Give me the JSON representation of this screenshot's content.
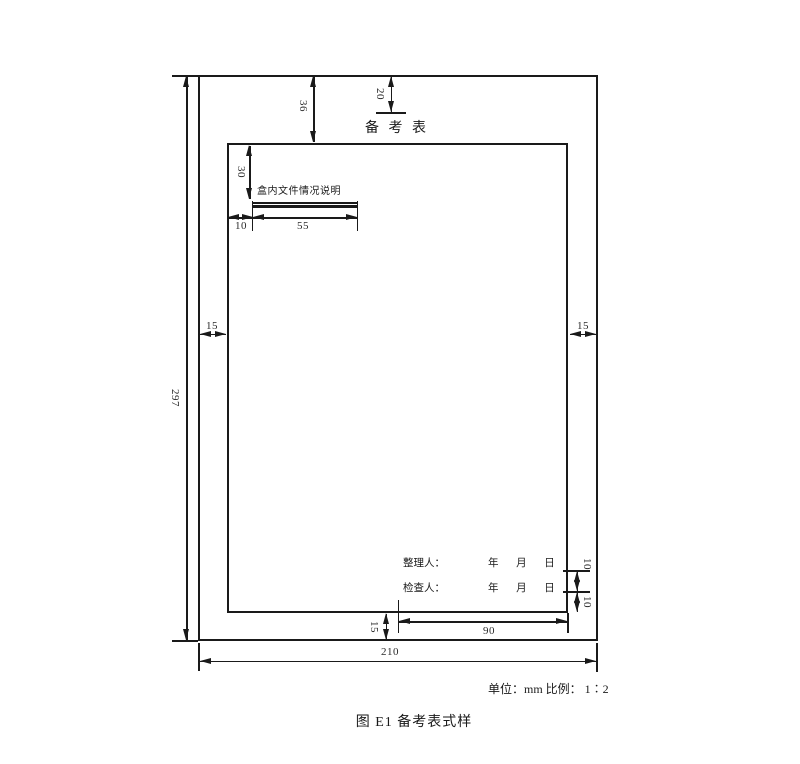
{
  "figure": {
    "title": "备 考 表",
    "caption": "图 E1 备考表式样",
    "units_scale": "单位：mm 比例： 1∶2"
  },
  "form": {
    "note": "盒内文件情况说明",
    "organizer": "整理人：",
    "checker": "检查人：",
    "date": "年 月 日"
  },
  "dims": {
    "page_height": "297",
    "page_width": "210",
    "margin_left": "15",
    "margin_right": "15",
    "title_offset": "20",
    "header": "36",
    "note_offset": "30",
    "note_indent": "10",
    "note_line": "55",
    "row_gap": "10",
    "row_bottom": "10",
    "bottom_margin": "15",
    "sign_width": "90"
  }
}
